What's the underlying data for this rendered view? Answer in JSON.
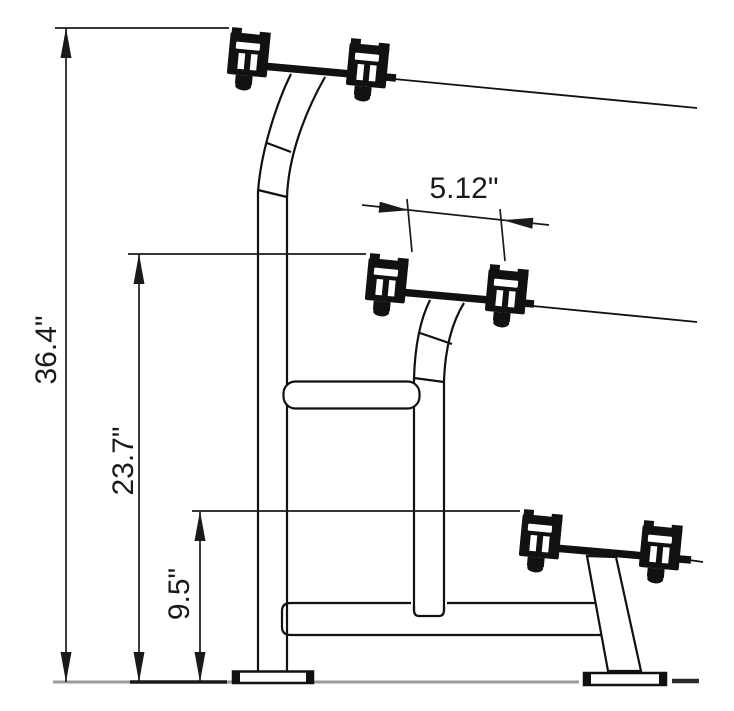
{
  "drawing": {
    "dimensions": {
      "total_height": "36.4\"",
      "middle_tier_height": "23.7\"",
      "bottom_tier_height": "9.5\"",
      "saddle_spacing": "5.12\""
    },
    "colors": {
      "line": "#1a1a1a",
      "solid": "#111111",
      "ground_line": "#9b9b9b",
      "background": "#ffffff"
    }
  }
}
